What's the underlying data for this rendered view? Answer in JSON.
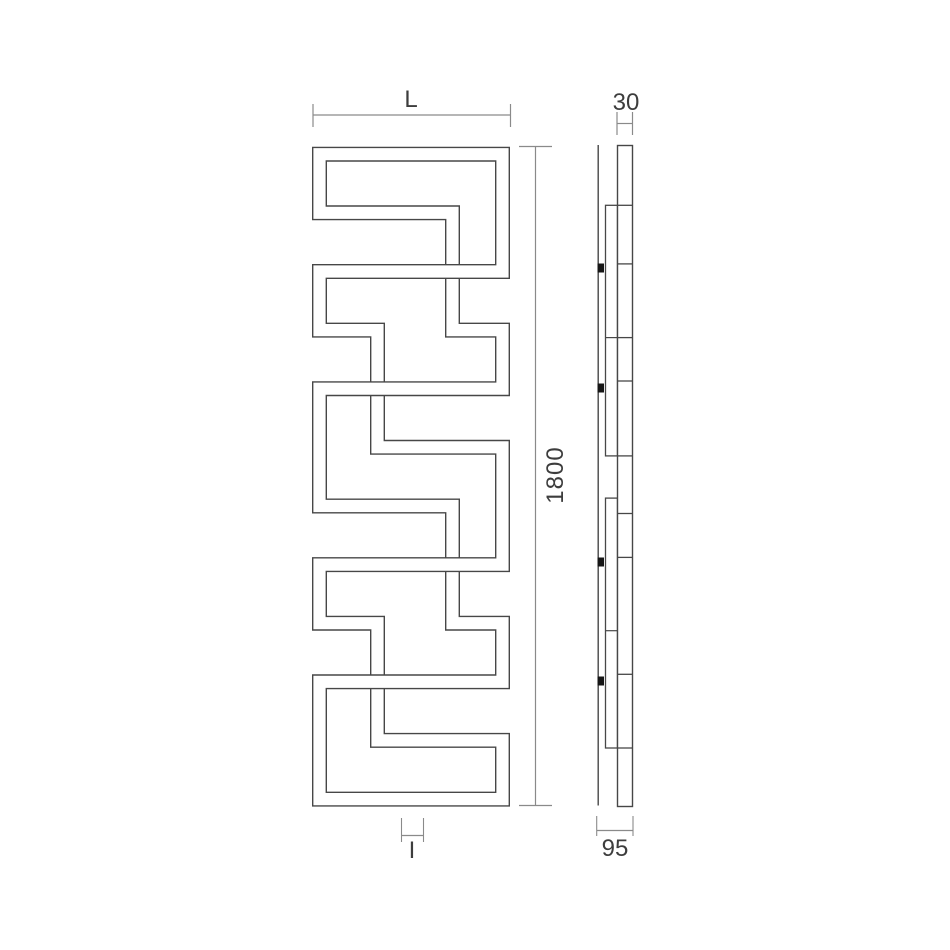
{
  "drawing": {
    "title": "radiator-dimension-drawing",
    "background": "#ffffff",
    "colors": {
      "object_line": "#474747",
      "tube_fill": "#ffffff",
      "dimension_line": "#8a8a8a",
      "text": "#3d3d3d",
      "bracket": "#161616"
    },
    "front_view": {
      "tube_outer_width": 15,
      "tube_inner_width": 12.2,
      "crossers": [
        {
          "x": 452.5,
          "y1": 244,
          "y2": 298
        },
        {
          "x": 377.5,
          "y1": 361,
          "y2": 415
        },
        {
          "x": 452.5,
          "y1": 537,
          "y2": 591
        },
        {
          "x": 377.5,
          "y1": 654,
          "y2": 708
        }
      ],
      "chains": [
        {
          "name": "tube-run-top",
          "points": [
            [
              377.5,
              367
            ],
            [
              377.5,
              330.1
            ],
            [
              319.5,
              330.1
            ],
            [
              319.5,
              271.5
            ],
            [
              502.5,
              271.5
            ],
            [
              502.5,
              154.2
            ],
            [
              319.5,
              154.2
            ],
            [
              319.5,
              212.8
            ],
            [
              452.5,
              212.8
            ],
            [
              452.5,
              250
            ]
          ]
        },
        {
          "name": "tube-run-upper-middle",
          "points": [
            [
              452.5,
              292
            ],
            [
              452.5,
              330.1
            ],
            [
              502.5,
              330.1
            ],
            [
              502.5,
              388.7
            ],
            [
              319.5,
              388.7
            ],
            [
              319.5,
              506.0
            ],
            [
              452.5,
              506.0
            ],
            [
              452.5,
              543
            ]
          ]
        },
        {
          "name": "tube-run-lower-middle",
          "points": [
            [
              377.5,
              660
            ],
            [
              377.5,
              623.2
            ],
            [
              319.5,
              623.2
            ],
            [
              319.5,
              564.6
            ],
            [
              502.5,
              564.6
            ],
            [
              502.5,
              447.3
            ],
            [
              377.5,
              447.3
            ],
            [
              377.5,
              409
            ]
          ]
        },
        {
          "name": "tube-run-bottom",
          "points": [
            [
              452.5,
              585
            ],
            [
              452.5,
              623.2
            ],
            [
              502.5,
              623.2
            ],
            [
              502.5,
              681.8
            ],
            [
              319.5,
              681.8
            ],
            [
              319.5,
              799.1
            ],
            [
              502.5,
              799.1
            ],
            [
              502.5,
              740.4
            ],
            [
              377.5,
              740.4
            ],
            [
              377.5,
              702
            ]
          ]
        }
      ]
    },
    "side_view": {
      "wall_line": {
        "x": 598.2,
        "y1": 145,
        "y2": 805.5
      },
      "mid_column": {
        "x": 605.5,
        "width": 12,
        "segments": [
          [
            205.3,
            455.9
          ],
          [
            498.1,
            748.0
          ]
        ],
        "divisions": [
          337.6,
          630.7
        ]
      },
      "body_column": {
        "x": 617.5,
        "width": 15,
        "y1": 145.5,
        "y2": 806.5,
        "divisions": [
          205.3,
          263.9,
          337.6,
          381.0,
          455.9,
          513.5,
          557.4,
          674.3,
          748.0
        ]
      },
      "brackets": {
        "x": 597.5,
        "width": 6.5,
        "height": 9,
        "y_centers": [
          268,
          388,
          562,
          681
        ]
      }
    },
    "dimensions": {
      "width": {
        "label": "L",
        "line": {
          "x1": 313,
          "y1": 115,
          "x2": 510.5,
          "y2": 115
        },
        "ticks": [
          {
            "x1": 313,
            "y1": 104,
            "x2": 313,
            "y2": 127
          },
          {
            "x1": 510.5,
            "y1": 104,
            "x2": 510.5,
            "y2": 127
          }
        ],
        "label_pos": {
          "x": 411,
          "y": 107
        },
        "font_size": 24
      },
      "height": {
        "label": "1800",
        "line": {
          "x1": 535.5,
          "y1": 146.5,
          "x2": 535.5,
          "y2": 805.5
        },
        "ticks": [
          {
            "x1": 519,
            "y1": 146.5,
            "x2": 552,
            "y2": 146.5
          },
          {
            "x1": 519,
            "y1": 805.5,
            "x2": 552,
            "y2": 805.5
          }
        ],
        "label_pos": {
          "x": 563,
          "y": 475
        },
        "rotate": -90,
        "font_size": 24,
        "letter_spacing": 1
      },
      "depth": {
        "label": "30",
        "line": {
          "x1": 617,
          "y1": 123.5,
          "x2": 632.5,
          "y2": 123.5
        },
        "ticks": [
          {
            "x1": 617,
            "y1": 112,
            "x2": 617,
            "y2": 135
          },
          {
            "x1": 632.5,
            "y1": 112,
            "x2": 632.5,
            "y2": 135
          }
        ],
        "label_pos": {
          "x": 626,
          "y": 110
        },
        "font_size": 24
      },
      "wall_distance": {
        "label": "95",
        "line": {
          "x1": 596.7,
          "y1": 830.5,
          "x2": 633,
          "y2": 830.5
        },
        "ext": [
          {
            "x1": 596.7,
            "y1": 816,
            "x2": 596.7,
            "y2": 836
          },
          {
            "x1": 633,
            "y1": 816,
            "x2": 633,
            "y2": 836
          }
        ],
        "label_pos": {
          "x": 615,
          "y": 856
        },
        "font_size": 24
      },
      "connection": {
        "label": "I",
        "line": {
          "x1": 401.5,
          "y1": 835.5,
          "x2": 423.5,
          "y2": 835.5
        },
        "ext": [
          {
            "x1": 401.5,
            "y1": 818,
            "x2": 401.5,
            "y2": 842
          },
          {
            "x1": 423.5,
            "y1": 818,
            "x2": 423.5,
            "y2": 842
          }
        ],
        "label_pos": {
          "x": 412,
          "y": 858
        },
        "font_size": 24
      }
    }
  }
}
